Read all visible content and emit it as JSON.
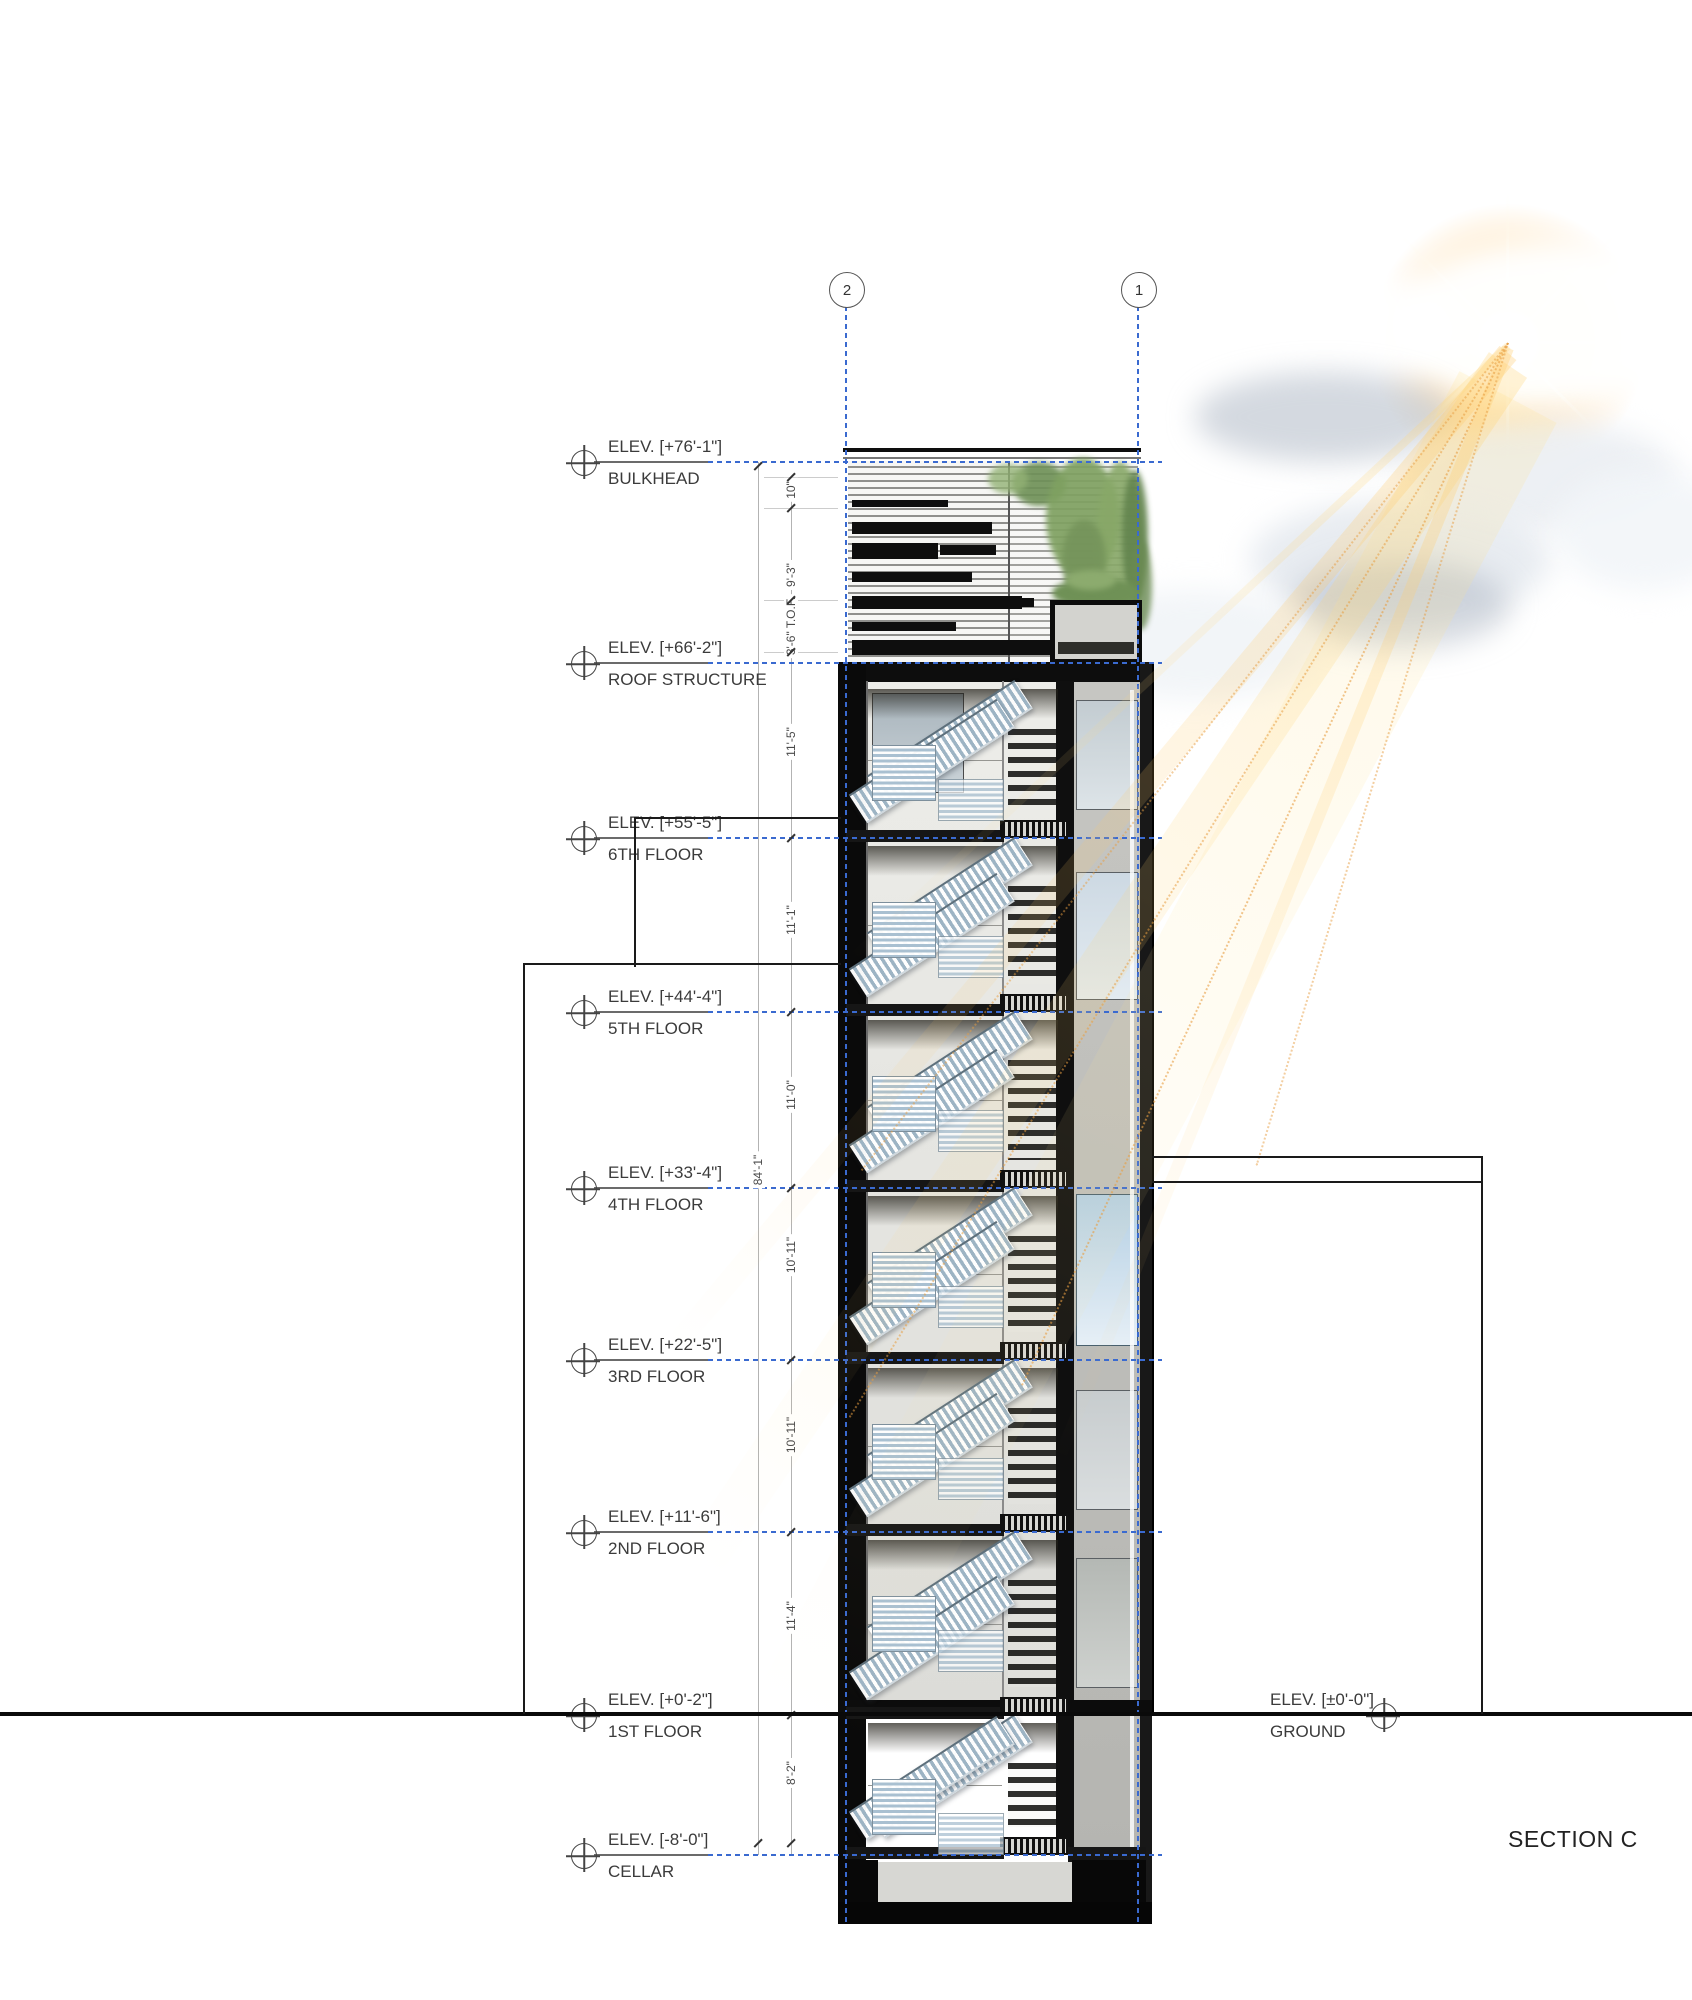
{
  "drawing": {
    "title": "SECTION C",
    "grid_bubbles": [
      {
        "label": "2",
        "x": 846
      },
      {
        "label": "1",
        "x": 1138
      }
    ],
    "markers": [
      {
        "elev": "ELEV. [+76'-1\"]",
        "label": "BULKHEAD",
        "y": 462,
        "side": "left"
      },
      {
        "elev": "ELEV. [+66'-2\"]",
        "label": "ROOF STRUCTURE",
        "y": 663,
        "side": "left"
      },
      {
        "elev": "ELEV. [+55'-5\"]",
        "label": "6TH FLOOR",
        "y": 838,
        "side": "left"
      },
      {
        "elev": "ELEV. [+44'-4\"]",
        "label": "5TH FLOOR",
        "y": 1012,
        "side": "left"
      },
      {
        "elev": "ELEV. [+33'-4\"]",
        "label": "4TH FLOOR",
        "y": 1188,
        "side": "left"
      },
      {
        "elev": "ELEV. [+22'-5\"]",
        "label": "3RD FLOOR",
        "y": 1360,
        "side": "left"
      },
      {
        "elev": "ELEV. [+11'-6\"]",
        "label": "2ND FLOOR",
        "y": 1532,
        "side": "left"
      },
      {
        "elev": "ELEV. [+0'-2\"]",
        "label": "1ST FLOOR",
        "y": 1715,
        "side": "left"
      },
      {
        "elev": "ELEV. [-8'-0\"]",
        "label": "CELLAR",
        "y": 1855,
        "side": "left"
      },
      {
        "elev": "ELEV. [±0'-0\"]",
        "label": "GROUND",
        "y": 1715,
        "side": "right"
      }
    ],
    "dims": [
      {
        "label": "10\"",
        "y": 490
      },
      {
        "label": "9'-3\"",
        "y": 575
      },
      {
        "label": "3'-6\" T.O.F.",
        "y": 626
      },
      {
        "label": "11'-5\"",
        "y": 742
      },
      {
        "label": "11'-1\"",
        "y": 920
      },
      {
        "label": "11'-0\"",
        "y": 1095
      },
      {
        "label": "10'-11\"",
        "y": 1255
      },
      {
        "label": "10'-11\"",
        "y": 1435
      },
      {
        "label": "11'-4\"",
        "y": 1616
      },
      {
        "label": "8'-2\"",
        "y": 1773
      }
    ],
    "overall_dim": {
      "label": "84'-1\"",
      "y": 1170
    },
    "ticks": {
      "inner": [
        477,
        508,
        600,
        652,
        838,
        1012,
        1188,
        1360,
        1532,
        1715,
        1843
      ],
      "outer": [
        466,
        1843
      ]
    },
    "colors": {
      "grid_blue": "#3a6ad0",
      "dim_grey": "#b3b3b3",
      "text": "#3b3b3b",
      "ground_black": "#0a0a0a"
    }
  }
}
